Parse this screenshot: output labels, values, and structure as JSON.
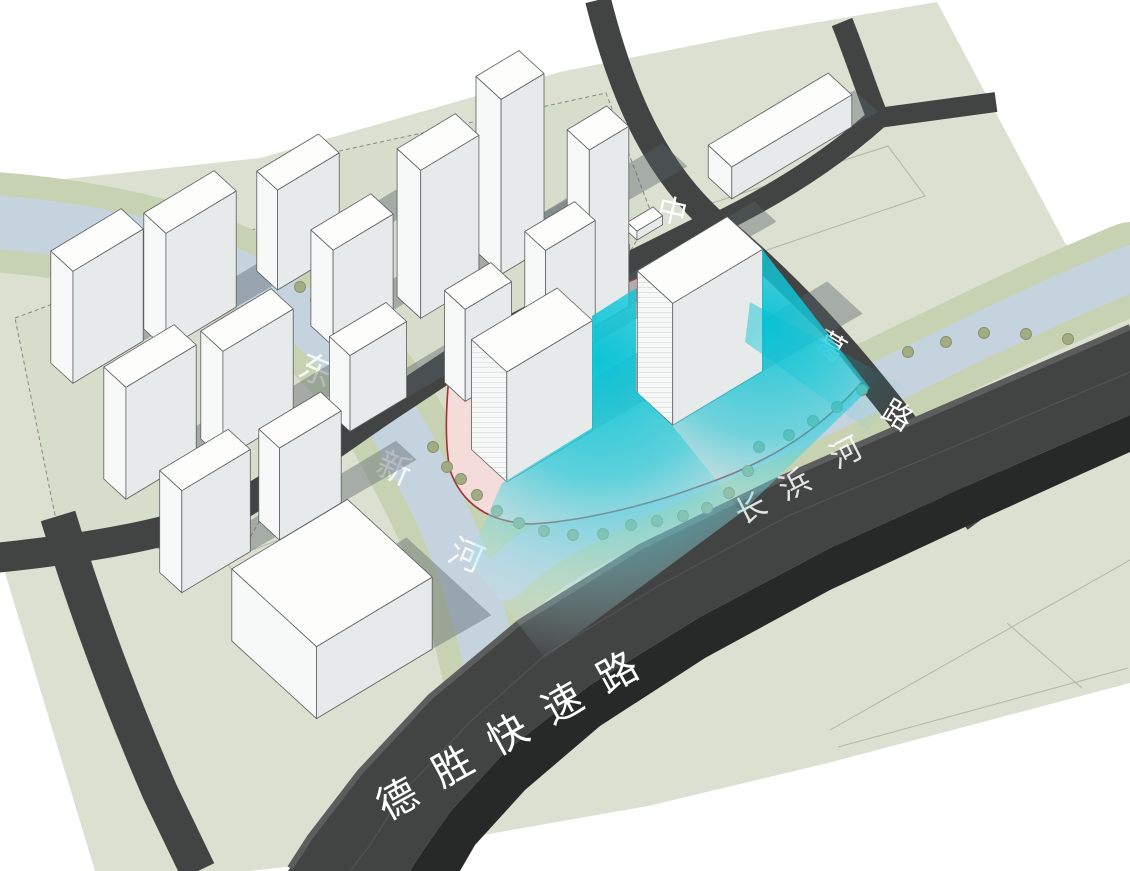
{
  "scene_type": "3d-urban-site-plan",
  "labels": {
    "north_road": "中丰",
    "east_road": "葛路",
    "west_river": "东新河",
    "south_river": "长浜河",
    "expressway": "德胜快速路"
  },
  "colors": {
    "land": "#dbe0d1",
    "land2": "#cfd7c0",
    "bank": "#c7d2b3",
    "water": "#c4d3de",
    "road": "#424444",
    "road_dark": "#272928",
    "building_top": "#fdfdfc",
    "building_front": "#f7f9f8",
    "building_side": "#e7eaea",
    "outline": "#5b5f60",
    "site_fill": "#f3dcda",
    "site_border": "#a03030",
    "view_cone": "#00c3d6",
    "tree": "#a2ac83",
    "shadow": "rgba(88,97,104,0.40)",
    "label_text": "#ffffff"
  }
}
